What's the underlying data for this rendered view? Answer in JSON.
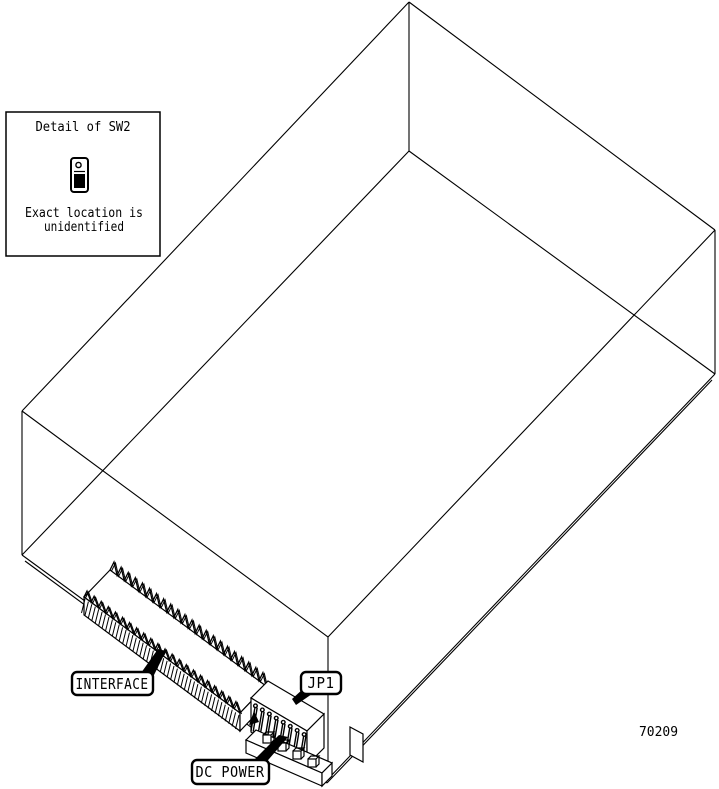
{
  "diagram": {
    "type": "hardware-connector-location-drawing",
    "background_color": "#ffffff",
    "line_color": "#000000",
    "detail_box": {
      "title": "Detail of SW2",
      "switch_icon": "dip-switch-icon",
      "note_line1": "Exact location is",
      "note_line2": "unidentified"
    },
    "labels": {
      "interface": "INTERFACE",
      "jp1": "JP1",
      "dc_power": "DC POWER"
    },
    "part_number": "70209"
  }
}
